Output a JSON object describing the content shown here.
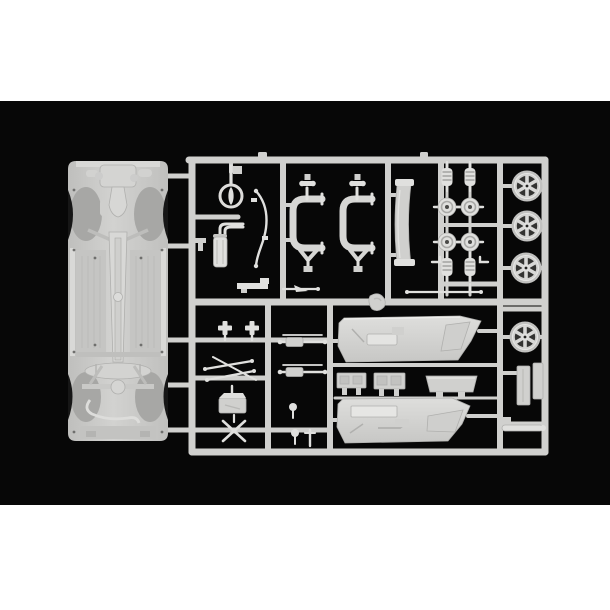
{
  "scene": {
    "description": "Product photograph of an unassembled light-grey injection-moulded plastic model car sprue (parts tree) lying on a black background, letterboxed with white margins above and below.",
    "alt": "Light grey model kit sprue containing a car chassis floor pan, four six-spoke wheels, coil springs, brake hubs, suspension subframes, exhaust, steering wheel, door panels and many small parts"
  },
  "colors": {
    "backdrop": "#ffffff",
    "photo_background": "#070707",
    "plastic": "#d0d0ce",
    "plastic_light": "#e0e0de",
    "plastic_mid": "#c6c6c4",
    "plastic_dark": "#a9a9a7",
    "shadow": "#161616"
  },
  "parts": {
    "runner_frame": "Sprue runner frame",
    "chassis": "Car chassis / floor pan",
    "steering_wheel": "Steering wheel",
    "exhaust": "Exhaust muffler with twin pipes",
    "antiroll_bar": "Anti-roll bar",
    "subframe_1": "Suspension subframe (left)",
    "subframe_2": "Suspension subframe (right)",
    "sill": "Curved sill / screen frame",
    "springs": "Coil springs (x4)",
    "hubs": "Brake hubs / discs (x4)",
    "wheels": "Six-spoke wheel rims (x4)",
    "long_rod": "Thin axle rod",
    "door_panel_1": "Door interior panel (upper)",
    "door_panel_2": "Door interior panel (lower)",
    "bracket_a": "Interior bracket A",
    "bracket_b": "Interior bracket B",
    "parcel_shelf": "Parcel shelf",
    "axles": "Axle assemblies (x2)",
    "suspension_arms": "Suspension arms",
    "gearbox": "Gearbox block",
    "x_brace": "X-shaped brace",
    "cross_mounts": "Cross-shaped mounts (x2)",
    "flat_bracket": "Flat step bracket",
    "lever": "Lever arm",
    "blob": "Moulding lump",
    "radiator_slabs": "Radiator slabs (x2)",
    "cylinder": "Cylindrical part",
    "small_pins": "Small pins and knobs"
  }
}
